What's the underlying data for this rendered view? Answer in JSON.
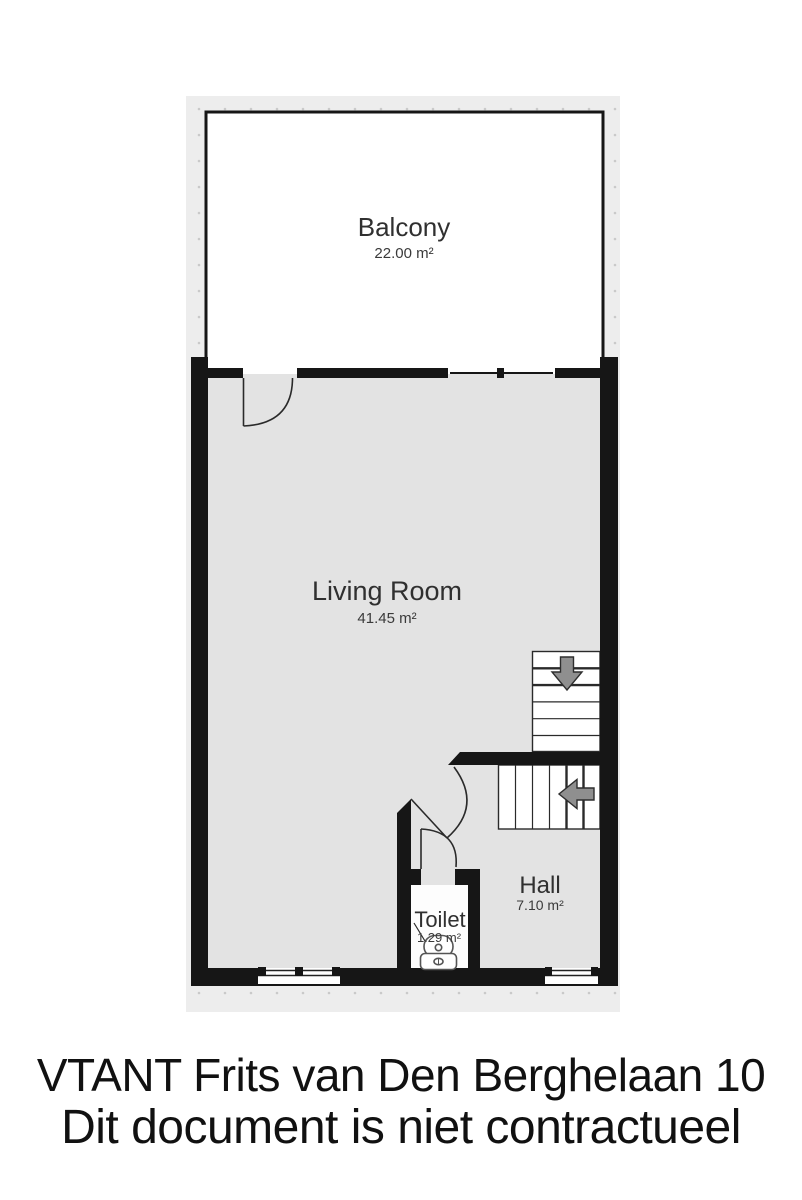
{
  "plan": {
    "rooms": {
      "balcony": {
        "name": "Balcony",
        "area": "22.00 m²"
      },
      "living_room": {
        "name": "Living Room",
        "area": "41.45 m²"
      },
      "hall": {
        "name": "Hall",
        "area": "7.10 m²"
      },
      "toilet": {
        "name": "Toilet",
        "area": "1.29 m²"
      }
    },
    "icons": {
      "upper_stairs": "arrow-down-icon",
      "lower_stairs": "arrow-left-icon",
      "fixture": "toilet-top-view-icon"
    },
    "colors": {
      "wall": "#161616",
      "floor": "#e3e3e3",
      "canvas_background": "#ededed",
      "room_white": "#ffffff",
      "arrow_fill": "#8f8f8f",
      "label_text": "#303030"
    }
  },
  "footer": {
    "line1": "VTANT Frits van Den Berghelaan 10",
    "line2": "Dit document is niet contractueel"
  }
}
